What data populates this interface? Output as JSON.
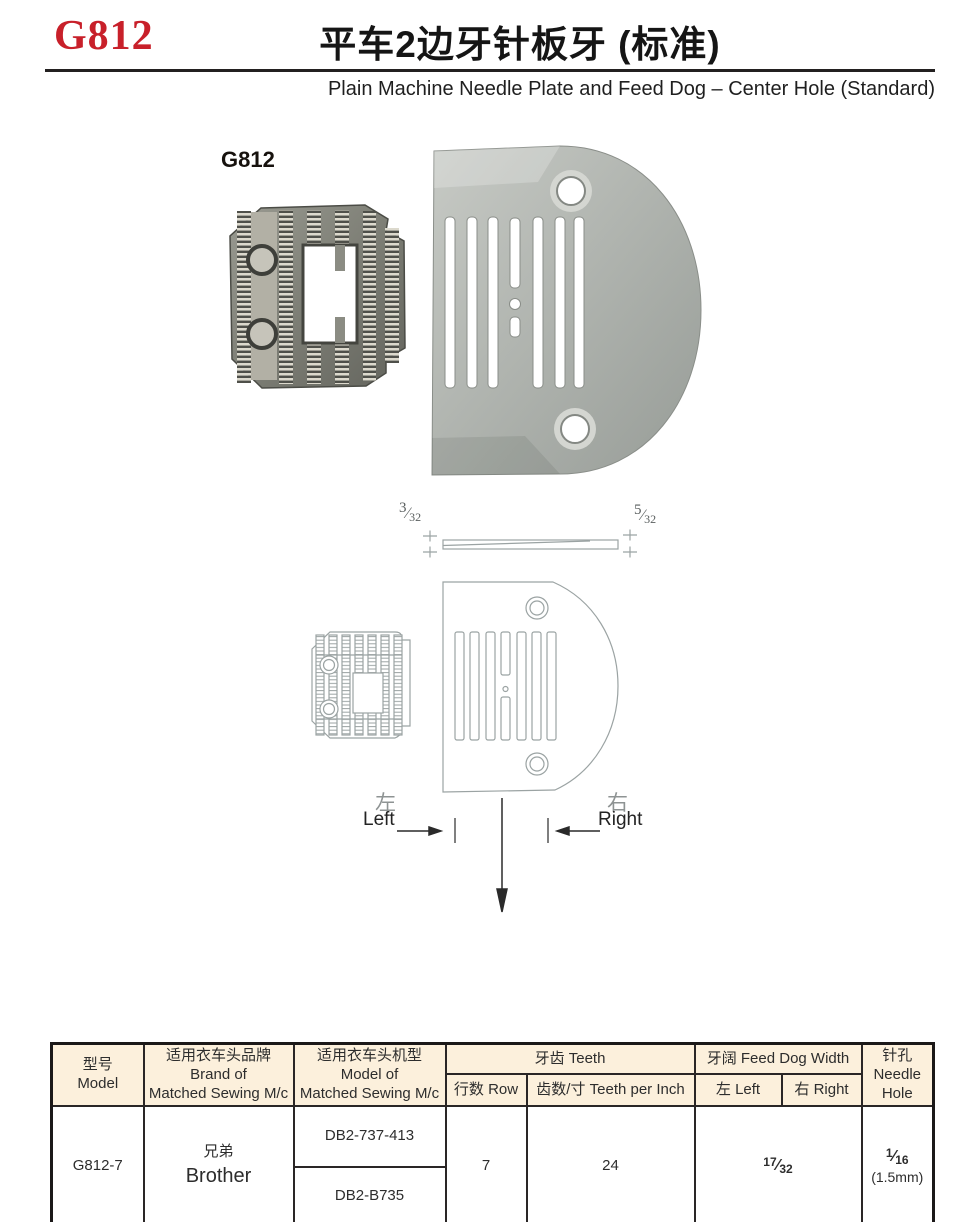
{
  "header": {
    "model_code": "G812",
    "title_zh": "平车2边牙针板牙 (标准)",
    "title_en": "Plain Machine Needle Plate and Feed Dog – Center Hole (Standard)"
  },
  "photo": {
    "label": "G812"
  },
  "diagram": {
    "thickness_left": "3/32",
    "thickness_right": "5/32",
    "left_zh": "左",
    "left_en": "Left",
    "right_zh": "右",
    "right_en": "Right"
  },
  "table": {
    "header": {
      "model_zh": "型号",
      "model_en": "Model",
      "brand_zh": "适用衣车头品牌",
      "brand_en_line1": "Brand of",
      "brand_en_line2": "Matched Sewing M/c",
      "machine_zh": "适用衣车头机型",
      "machine_en_line1": "Model of",
      "machine_en_line2": "Matched Sewing M/c",
      "teeth": "牙齿 Teeth",
      "row": "行数 Row",
      "teeth_per_inch": "齿数/寸 Teeth per Inch",
      "feed_dog_width": "牙阔 Feed Dog Width",
      "left": "左 Left",
      "right": "右 Right",
      "needle_hole_zh": "针孔",
      "needle_hole_en_line1": "Needle",
      "needle_hole_en_line2": "Hole"
    },
    "row": {
      "model": "G812-7",
      "brand_zh": "兄弟",
      "brand_en": "Brother",
      "machine_models": [
        "DB2-737-413",
        "DB2-B735"
      ],
      "teeth_rows": "7",
      "teeth_per_inch": "24",
      "feed_dog_width": "17/32",
      "needle_hole": "1/16",
      "needle_hole_mm": "(1.5mm)"
    }
  },
  "colors": {
    "accent_red": "#c8202a",
    "table_header_bg": "#fcf0dc",
    "drawing_line": "#9ba3a3",
    "metal_gray": "#b3b7b2"
  }
}
